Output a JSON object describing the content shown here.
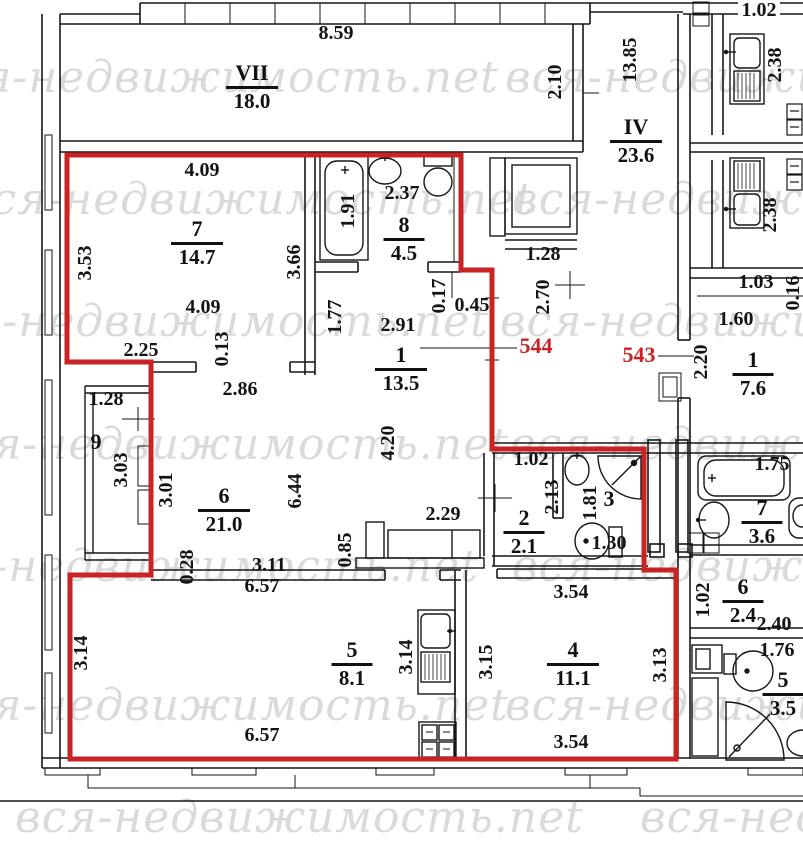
{
  "watermark": {
    "text": "вся-недвижимость.net",
    "color": "#d2d2d2",
    "positions": [
      {
        "x": -70,
        "y": 52
      },
      {
        "x": 505,
        "y": 52
      },
      {
        "x": -35,
        "y": 174
      },
      {
        "x": 512,
        "y": 174
      },
      {
        "x": -80,
        "y": 296
      },
      {
        "x": 500,
        "y": 296
      },
      {
        "x": -60,
        "y": 419
      },
      {
        "x": 510,
        "y": 419
      },
      {
        "x": -90,
        "y": 541
      },
      {
        "x": 512,
        "y": 541
      },
      {
        "x": -60,
        "y": 680
      },
      {
        "x": 505,
        "y": 680
      },
      {
        "x": 15,
        "y": 792
      },
      {
        "x": 640,
        "y": 792
      }
    ]
  },
  "colors": {
    "line": "#161616",
    "red": "#c92323"
  },
  "apartment_numbers": [
    {
      "text": "544",
      "x": 536,
      "y": 346
    },
    {
      "text": "543",
      "x": 639,
      "y": 355
    }
  ],
  "rooms": [
    {
      "number": "VII",
      "area": "18.0",
      "x": 252,
      "y": 62
    },
    {
      "number": "IV",
      "area": "23.6",
      "x": 636,
      "y": 116
    },
    {
      "number": "7",
      "area": "14.7",
      "x": 197,
      "y": 218
    },
    {
      "number": "8",
      "area": "4.5",
      "x": 404,
      "y": 214
    },
    {
      "number": "1",
      "area": "13.5",
      "x": 401,
      "y": 344
    },
    {
      "number": "9",
      "area": "",
      "x": 96,
      "y": 431
    },
    {
      "number": "6",
      "area": "21.0",
      "x": 224,
      "y": 485
    },
    {
      "number": "2",
      "area": "2.1",
      "x": 524,
      "y": 507
    },
    {
      "number": "3",
      "area": "",
      "x": 609,
      "y": 488
    },
    {
      "number": "5",
      "area": "8.1",
      "x": 352,
      "y": 639
    },
    {
      "number": "4",
      "area": "11.1",
      "x": 573,
      "y": 639
    },
    {
      "number": "1",
      "area": "7.6",
      "x": 753,
      "y": 349
    },
    {
      "number": "7",
      "area": "3.6",
      "x": 762,
      "y": 497
    },
    {
      "number": "6",
      "area": "2.4",
      "x": 743,
      "y": 576
    },
    {
      "number": "5",
      "area": "3.5",
      "x": 783,
      "y": 669
    }
  ],
  "dimensions": [
    {
      "text": "8.59",
      "x": 336,
      "y": 33,
      "rot": 0
    },
    {
      "text": "1.02",
      "x": 759,
      "y": 10,
      "rot": 0
    },
    {
      "text": "2.10",
      "x": 555,
      "y": 82,
      "rot": 1
    },
    {
      "text": "13.85",
      "x": 630,
      "y": 60,
      "rot": 1
    },
    {
      "text": "2.38",
      "x": 775,
      "y": 65,
      "rot": 1
    },
    {
      "text": "4.09",
      "x": 202,
      "y": 170,
      "rot": 0
    },
    {
      "text": "1.91",
      "x": 348,
      "y": 211,
      "rot": 1
    },
    {
      "text": "2.37",
      "x": 402,
      "y": 193,
      "rot": 0
    },
    {
      "text": "2.38",
      "x": 770,
      "y": 215,
      "rot": 1
    },
    {
      "text": "3.53",
      "x": 85,
      "y": 263,
      "rot": 1
    },
    {
      "text": "3.66",
      "x": 294,
      "y": 262,
      "rot": 1
    },
    {
      "text": "1.28",
      "x": 543,
      "y": 254,
      "rot": 0
    },
    {
      "text": "2.70",
      "x": 543,
      "y": 297,
      "rot": 1
    },
    {
      "text": "1.03",
      "x": 756,
      "y": 282,
      "rot": 0
    },
    {
      "text": "0.16",
      "x": 793,
      "y": 293,
      "rot": 1
    },
    {
      "text": "1.60",
      "x": 736,
      "y": 319,
      "rot": 0
    },
    {
      "text": "4.09",
      "x": 203,
      "y": 307,
      "rot": 0
    },
    {
      "text": "2.25",
      "x": 141,
      "y": 350,
      "rot": 0
    },
    {
      "text": "0.13",
      "x": 222,
      "y": 349,
      "rot": 1
    },
    {
      "text": "2.86",
      "x": 240,
      "y": 389,
      "rot": 0
    },
    {
      "text": "1.77",
      "x": 335,
      "y": 317,
      "rot": 1
    },
    {
      "text": "2.91",
      "x": 398,
      "y": 325,
      "rot": 0
    },
    {
      "text": "0.17",
      "x": 439,
      "y": 296,
      "rot": 1
    },
    {
      "text": "0.45",
      "x": 472,
      "y": 305,
      "rot": 0
    },
    {
      "text": "2.20",
      "x": 701,
      "y": 362,
      "rot": 1
    },
    {
      "text": "1.28",
      "x": 106,
      "y": 399,
      "rot": 0
    },
    {
      "text": "3.03",
      "x": 121,
      "y": 470,
      "rot": 1
    },
    {
      "text": "3.01",
      "x": 166,
      "y": 490,
      "rot": 1
    },
    {
      "text": "6.44",
      "x": 295,
      "y": 491,
      "rot": 1
    },
    {
      "text": "4.20",
      "x": 388,
      "y": 443,
      "rot": 1
    },
    {
      "text": "1.02",
      "x": 531,
      "y": 459,
      "rot": 0
    },
    {
      "text": "2.13",
      "x": 552,
      "y": 497,
      "rot": 1
    },
    {
      "text": "1.81",
      "x": 590,
      "y": 503,
      "rot": 1
    },
    {
      "text": "1.30",
      "x": 609,
      "y": 543,
      "rot": 0
    },
    {
      "text": "1.75",
      "x": 772,
      "y": 464,
      "rot": 0
    },
    {
      "text": "2.29",
      "x": 443,
      "y": 514,
      "rot": 0
    },
    {
      "text": "0.85",
      "x": 345,
      "y": 550,
      "rot": 1
    },
    {
      "text": "0.28",
      "x": 187,
      "y": 567,
      "rot": 1
    },
    {
      "text": "3.11",
      "x": 269,
      "y": 565,
      "rot": 0
    },
    {
      "text": "6.57",
      "x": 262,
      "y": 586,
      "rot": 0
    },
    {
      "text": "1.02",
      "x": 703,
      "y": 600,
      "rot": 1
    },
    {
      "text": "2.40",
      "x": 774,
      "y": 624,
      "rot": 0
    },
    {
      "text": "1.76",
      "x": 777,
      "y": 650,
      "rot": 0
    },
    {
      "text": "3.14",
      "x": 81,
      "y": 653,
      "rot": 1
    },
    {
      "text": "3.14",
      "x": 406,
      "y": 657,
      "rot": 1
    },
    {
      "text": "3.15",
      "x": 486,
      "y": 662,
      "rot": 1
    },
    {
      "text": "3.13",
      "x": 660,
      "y": 665,
      "rot": 1
    },
    {
      "text": "3.54",
      "x": 571,
      "y": 592,
      "rot": 0
    },
    {
      "text": "6.57",
      "x": 262,
      "y": 735,
      "rot": 0
    },
    {
      "text": "3.54",
      "x": 571,
      "y": 742,
      "rot": 0
    }
  ]
}
